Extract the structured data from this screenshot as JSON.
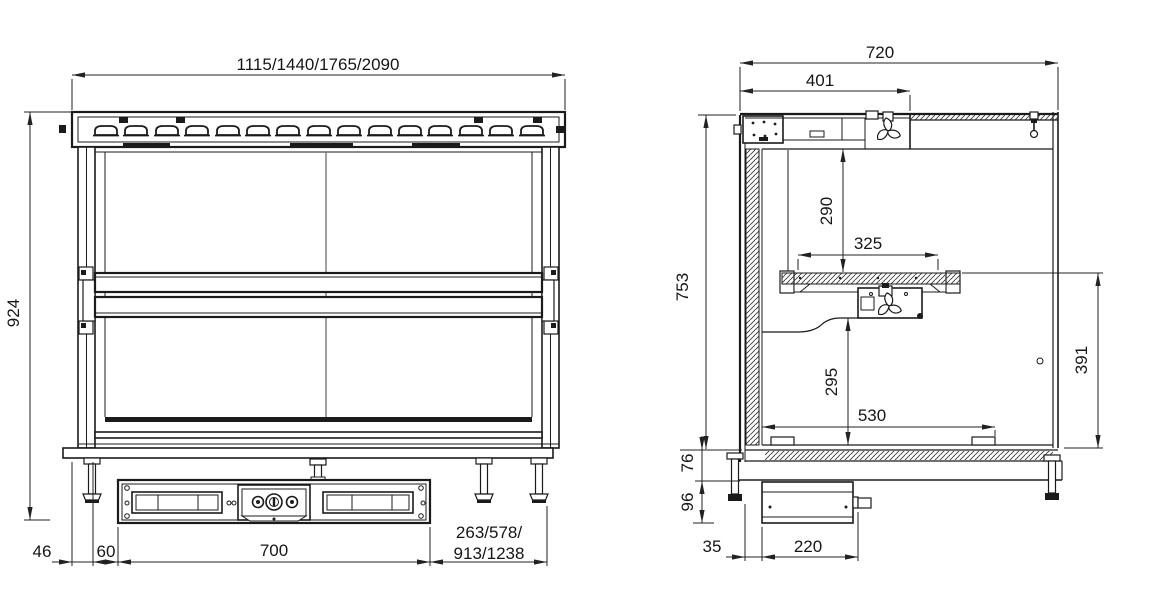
{
  "front_view": {
    "dimensions": {
      "overall_width_variants": "1115/1440/1765/2090",
      "overall_height": "924",
      "edge_to_body": "46",
      "body_to_cutout": "60",
      "cutout_width": "700",
      "right_extension_variants_line1": "263/578/",
      "right_extension_variants_line2": "913/1238"
    }
  },
  "side_view": {
    "dimensions": {
      "overall_depth": "720",
      "cooling_unit_depth": "401",
      "overall_height": "753",
      "ceiling_to_shelf": "290",
      "shelf_depth": "325",
      "duct_to_floor": "295",
      "floor_depth": "530",
      "shelf_to_floor": "391",
      "flange_height": "76",
      "compressor_box_height": "96",
      "wall_to_compressor": "35",
      "compressor_box_depth": "220"
    }
  },
  "style": {
    "line_color": "#1b1b1b",
    "text_color": "#161616",
    "background": "#ffffff"
  }
}
